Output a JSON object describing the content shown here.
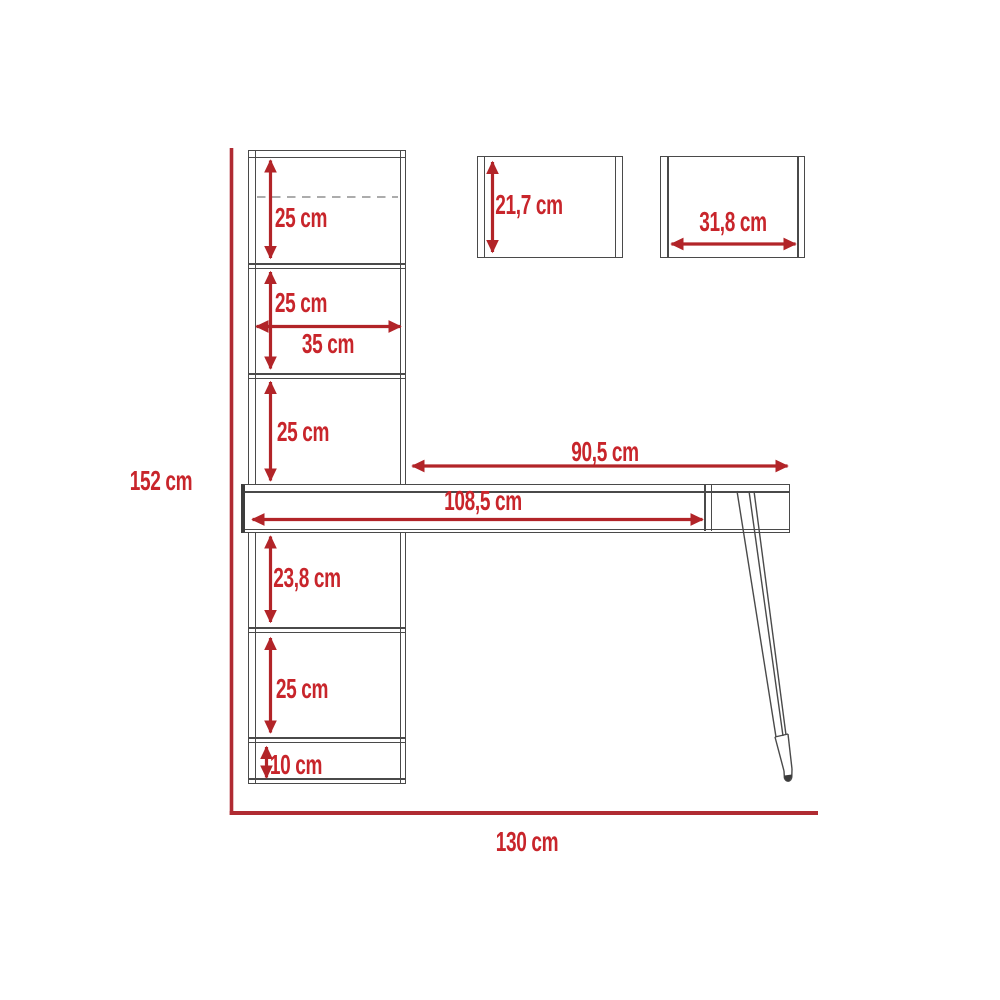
{
  "diagram_title": "furniture-dimension-diagram",
  "colors": {
    "dimension_red": "#b22428",
    "label_red": "#c8252b",
    "axis_red": "#b02b32",
    "structure_gray": "#4a4a4a"
  },
  "overall": {
    "height": "152 cm",
    "width": "130 cm"
  },
  "bookcase": {
    "shelf_width": "35 cm",
    "sections": [
      "25 cm",
      "25 cm",
      "25 cm",
      "23,8 cm",
      "25 cm",
      "10 cm"
    ]
  },
  "desk": {
    "drawer_width": "108,5 cm",
    "worktop_width": "90,5 cm"
  },
  "panels": {
    "small_panel_height": "21,7 cm",
    "large_panel_width": "31,8 cm"
  }
}
